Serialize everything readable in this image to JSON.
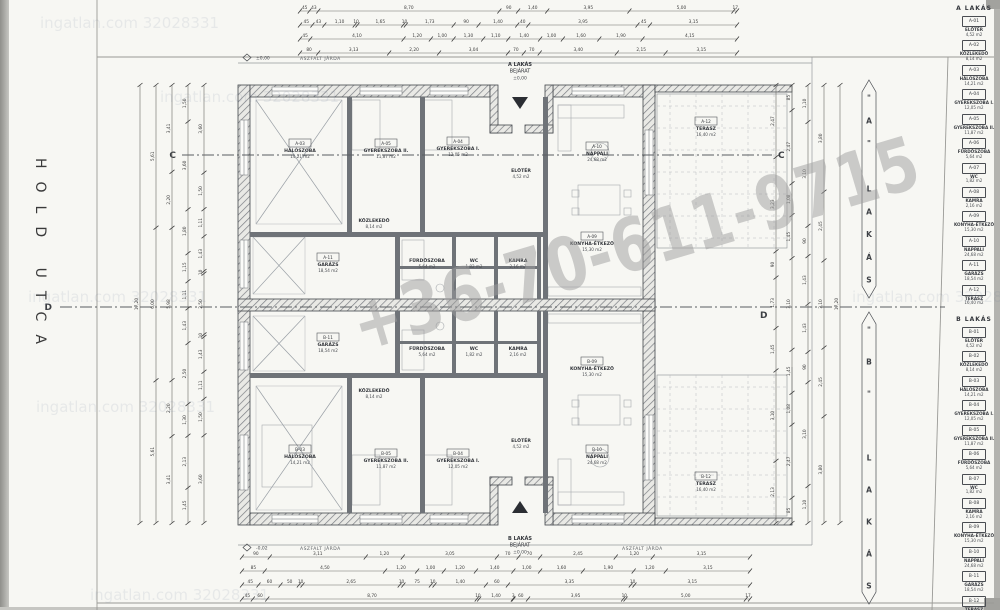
{
  "page": {
    "street": "HOLD UTCA",
    "watermark_phone": "+36-70-611-9715",
    "watermark_site": "ingatlan.com 32028331"
  },
  "sections": {
    "c": "C",
    "d": "D"
  },
  "notes": {
    "sidewalk": "ASZFALT JÁRDA",
    "level_top": "±0,00",
    "level_bottom": "-0,02"
  },
  "entrances": {
    "a": {
      "line1": "A LAKÁS",
      "line2": "BEJÁRAT",
      "level": "±0,00"
    },
    "b": {
      "line1": "B LAKÁS",
      "line2": "BEJÁRAT",
      "level": "±0,00"
    }
  },
  "banners": [
    {
      "text": "\"A\" LAKÁS",
      "x": 869,
      "y1": 80,
      "y2": 298
    },
    {
      "text": "\"B\" LAKÁS",
      "x": 869,
      "y1": 312,
      "y2": 604
    }
  ],
  "schedule": {
    "a": {
      "title": "A LAKÁS",
      "items": [
        {
          "code": "A-01",
          "name": "ELŐTÉR",
          "area": "4,52 m2"
        },
        {
          "code": "A-02",
          "name": "KÖZLEKEDŐ",
          "area": "8,14 m2"
        },
        {
          "code": "A-03",
          "name": "HÁLÓSZOBA",
          "area": "14,21 m2"
        },
        {
          "code": "A-04",
          "name": "GYEREKSZOBA I.",
          "area": "12,05 m2"
        },
        {
          "code": "A-05",
          "name": "GYEREKSZOBA II.",
          "area": "11,87 m2"
        },
        {
          "code": "A-06",
          "name": "FÜRDŐSZOBA",
          "area": "5,64 m2"
        },
        {
          "code": "A-07",
          "name": "WC",
          "area": "1,82 m2"
        },
        {
          "code": "A-08",
          "name": "KAMRA",
          "area": "2,16 m2"
        },
        {
          "code": "A-09",
          "name": "KONYHA-ÉTKEZŐ",
          "area": "15,30 m2"
        },
        {
          "code": "A-10",
          "name": "NAPPALI",
          "area": "24,68 m2"
        },
        {
          "code": "A-11",
          "name": "GARÁZS",
          "area": "18,54 m2"
        },
        {
          "code": "A-12",
          "name": "TERASZ",
          "area": "16,40 m2"
        }
      ]
    },
    "b": {
      "title": "B LAKÁS",
      "items": [
        {
          "code": "B-01",
          "name": "ELŐTÉR",
          "area": "4,52 m2"
        },
        {
          "code": "B-02",
          "name": "KÖZLEKEDŐ",
          "area": "8,14 m2"
        },
        {
          "code": "B-03",
          "name": "HÁLÓSZOBA",
          "area": "14,21 m2"
        },
        {
          "code": "B-04",
          "name": "GYEREKSZOBA I.",
          "area": "12,05 m2"
        },
        {
          "code": "B-05",
          "name": "GYEREKSZOBA II.",
          "area": "11,87 m2"
        },
        {
          "code": "B-06",
          "name": "FÜRDŐSZOBA",
          "area": "5,64 m2"
        },
        {
          "code": "B-07",
          "name": "WC",
          "area": "1,82 m2"
        },
        {
          "code": "B-08",
          "name": "KAMRA",
          "area": "2,16 m2"
        },
        {
          "code": "B-09",
          "name": "KONYHA-ÉTKEZŐ",
          "area": "15,30 m2"
        },
        {
          "code": "B-10",
          "name": "NAPPALI",
          "area": "24,68 m2"
        },
        {
          "code": "B-11",
          "name": "GARÁZS",
          "area": "18,54 m2"
        },
        {
          "code": "B-12",
          "name": "TERASZ",
          "area": "16,40 m2"
        }
      ]
    }
  },
  "plan_labels": [
    {
      "u": "a",
      "i": 2,
      "x": 300,
      "y": 152,
      "box": true
    },
    {
      "u": "a",
      "i": 4,
      "x": 386,
      "y": 152,
      "box": true
    },
    {
      "u": "a",
      "i": 3,
      "x": 458,
      "y": 150,
      "box": true
    },
    {
      "u": "a",
      "i": 9,
      "x": 597,
      "y": 155,
      "box": true
    },
    {
      "u": "a",
      "i": 11,
      "x": 706,
      "y": 130,
      "box": true
    },
    {
      "u": "a",
      "i": 10,
      "x": 328,
      "y": 266,
      "box": true
    },
    {
      "u": "a",
      "i": 8,
      "x": 592,
      "y": 245,
      "box": true
    },
    {
      "u": "a",
      "i": 0,
      "x": 521,
      "y": 172,
      "box": false
    },
    {
      "u": "a",
      "i": 1,
      "x": 374,
      "y": 222,
      "box": false
    },
    {
      "u": "a",
      "i": 5,
      "x": 427,
      "y": 262,
      "box": false
    },
    {
      "u": "a",
      "i": 6,
      "x": 474,
      "y": 262,
      "box": false
    },
    {
      "u": "a",
      "i": 7,
      "x": 518,
      "y": 262,
      "box": false
    },
    {
      "u": "b",
      "i": 2,
      "x": 300,
      "y": 458,
      "box": true
    },
    {
      "u": "b",
      "i": 4,
      "x": 386,
      "y": 462,
      "box": true
    },
    {
      "u": "b",
      "i": 3,
      "x": 458,
      "y": 462,
      "box": true
    },
    {
      "u": "b",
      "i": 9,
      "x": 597,
      "y": 458,
      "box": true
    },
    {
      "u": "b",
      "i": 11,
      "x": 706,
      "y": 485,
      "box": true
    },
    {
      "u": "b",
      "i": 10,
      "x": 328,
      "y": 346,
      "box": true
    },
    {
      "u": "b",
      "i": 8,
      "x": 592,
      "y": 370,
      "box": true
    },
    {
      "u": "b",
      "i": 0,
      "x": 521,
      "y": 442,
      "box": false
    },
    {
      "u": "b",
      "i": 1,
      "x": 374,
      "y": 392,
      "box": false
    },
    {
      "u": "b",
      "i": 5,
      "x": 427,
      "y": 350,
      "box": false
    },
    {
      "u": "b",
      "i": 6,
      "x": 474,
      "y": 350,
      "box": false
    },
    {
      "u": "b",
      "i": 7,
      "x": 518,
      "y": 350,
      "box": false
    }
  ],
  "dims": {
    "chains": [
      {
        "o": "h",
        "x1": 300,
        "x2": 737,
        "y": 11,
        "vals": [
          "45",
          "43",
          "8,70",
          "90",
          "1,40",
          "3,95",
          "5,00",
          "17"
        ]
      },
      {
        "o": "h",
        "x1": 300,
        "x2": 737,
        "y": 25,
        "vals": [
          "45",
          "43",
          "1,10",
          "10",
          "1,65",
          "10",
          "1,73",
          "90",
          "1,40",
          "40",
          "3,95",
          "45",
          "3,15"
        ]
      },
      {
        "o": "h",
        "x1": 300,
        "x2": 737,
        "y": 39,
        "vals": [
          "45",
          "4,10",
          "1,20",
          "1,00",
          "1,30",
          "1,10",
          "1,40",
          "1,00",
          "1,60",
          "1,90",
          "4,15"
        ]
      },
      {
        "o": "h",
        "x1": 300,
        "x2": 737,
        "y": 53,
        "vals": [
          "80",
          "3,13",
          "2,20",
          "3,04",
          "70",
          "70",
          "3,40",
          "2,15",
          "3,15"
        ]
      },
      {
        "o": "h",
        "x1": 242,
        "x2": 750,
        "y": 557,
        "vals": [
          "90",
          "3,11",
          "1,20",
          "3,05",
          "70",
          "70",
          "2,45",
          "1,20",
          "3,15"
        ]
      },
      {
        "o": "h",
        "x1": 242,
        "x2": 750,
        "y": 571,
        "vals": [
          "85",
          "4,50",
          "1,20",
          "1,00",
          "1,20",
          "1,40",
          "1,00",
          "1,60",
          "1,90",
          "1,20",
          "3,15"
        ]
      },
      {
        "o": "h",
        "x1": 242,
        "x2": 750,
        "y": 585,
        "vals": [
          "45",
          "60",
          "50",
          "10",
          "2,65",
          "10",
          "75",
          "10",
          "1,40",
          "60",
          "3,35",
          "10",
          "3,15"
        ]
      },
      {
        "o": "h",
        "x1": 242,
        "x2": 750,
        "y": 599,
        "vals": [
          "45",
          "60",
          "8,70",
          "10",
          "1,40",
          "3",
          "60",
          "3,95",
          "10",
          "5,00",
          "17"
        ]
      },
      {
        "o": "v",
        "x": 140,
        "y1": 85,
        "y2": 523,
        "vals": [
          "17,20"
        ]
      },
      {
        "o": "v",
        "x": 156,
        "y1": 85,
        "y2": 523,
        "vals": [
          "5,61",
          "6,00",
          "5,61"
        ]
      },
      {
        "o": "v",
        "x": 172,
        "y1": 85,
        "y2": 523,
        "vals": [
          "3,41",
          "2,20",
          "5,98",
          "2,20",
          "3,41"
        ]
      },
      {
        "o": "v",
        "x": 188,
        "y1": 85,
        "y2": 523,
        "vals": [
          "1,50",
          "3,60",
          "1,80",
          "1,15",
          "1,11",
          "1,43",
          "2,50",
          "1,30",
          "2,13",
          "1,45"
        ]
      },
      {
        "o": "v",
        "x": 204,
        "y1": 85,
        "y2": 523,
        "vals": [
          "3,60",
          "1,50",
          "1,11",
          "1,43",
          "10",
          "2,50",
          "10",
          "1,43",
          "1,11",
          "1,50",
          "3,60"
        ]
      },
      {
        "o": "v",
        "x": 776,
        "y1": 85,
        "y2": 523,
        "vals": [
          "2,47",
          "3,23",
          "90",
          "1,73",
          "1,45",
          "3,10",
          "2,13"
        ]
      },
      {
        "o": "v",
        "x": 792,
        "y1": 85,
        "y2": 523,
        "vals": [
          "85",
          "2,47",
          "1,08",
          "1,45",
          "3,10",
          "1,45",
          "1,08",
          "2,47",
          "85"
        ]
      },
      {
        "o": "v",
        "x": 808,
        "y1": 85,
        "y2": 523,
        "vals": [
          "1,10",
          "3,10",
          "90",
          "1,43",
          "1,43",
          "90",
          "3,10",
          "1,10"
        ]
      },
      {
        "o": "v",
        "x": 824,
        "y1": 85,
        "y2": 523,
        "vals": [
          "3,80",
          "2,45",
          "3,10",
          "2,45",
          "3,80"
        ]
      },
      {
        "o": "v",
        "x": 840,
        "y1": 85,
        "y2": 523,
        "vals": [
          "17,20"
        ]
      }
    ]
  }
}
